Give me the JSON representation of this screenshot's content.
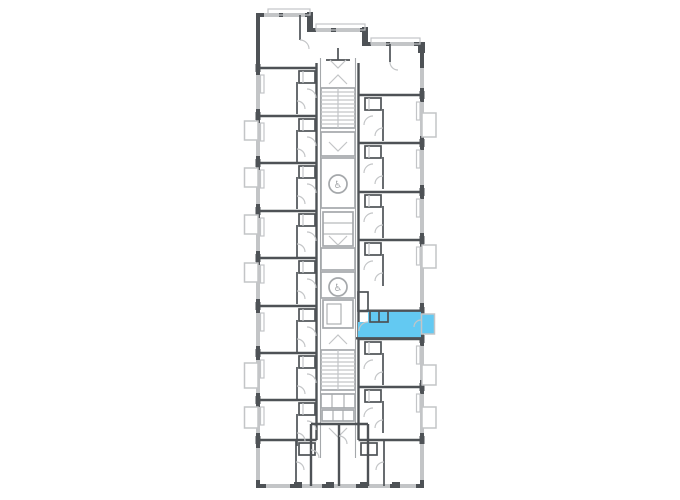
{
  "app": {
    "name": "residential-floor-plan-viewer"
  },
  "plan": {
    "type": "apartment-tower-floor-plan",
    "colors": {
      "background": "#ffffff",
      "walls": "#4e5256",
      "light_lines": "#c3c5c7",
      "core_lines": "#a5a8ab",
      "highlight": "#63c9f2"
    },
    "icons": {
      "accessible_elevator_glyph": "♿"
    },
    "features": {
      "staircases": 2,
      "accessible_elevators": 2,
      "selected_units": 1
    },
    "selected_unit": {
      "wing": "right",
      "position": "lower-middle",
      "has_balcony": true,
      "status": "selected"
    }
  }
}
